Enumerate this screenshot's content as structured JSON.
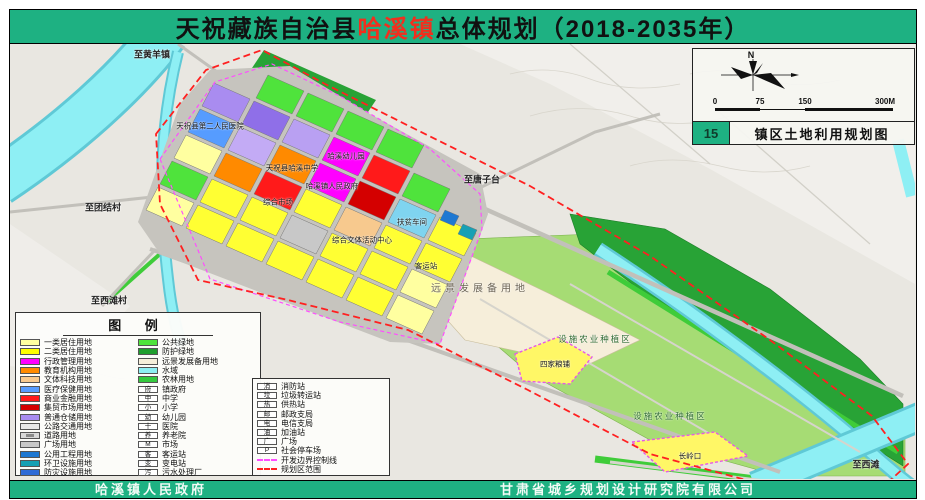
{
  "title": {
    "prefix": "天祝藏族自治县",
    "highlight": "哈溪镇",
    "suffix": "总体规划（2018-2035年）"
  },
  "map_index": {
    "number": "15",
    "name": "镇区土地利用规划图"
  },
  "compass": {
    "north_label": "N"
  },
  "scale_bar": {
    "ticks": [
      "0",
      "75",
      "150",
      "300M"
    ]
  },
  "legend": {
    "title": "图  例",
    "col1": [
      {
        "label": "一类居住用地",
        "c": "#ffffa0"
      },
      {
        "label": "二类居住用地",
        "c": "#ffff00"
      },
      {
        "label": "行政管理用地",
        "c": "#ff00ff"
      },
      {
        "label": "教育机构用地",
        "c": "#ff8a00"
      },
      {
        "label": "文体科技用地",
        "c": "#f7c98e"
      },
      {
        "label": "医疗保健用地",
        "c": "#569cff"
      },
      {
        "label": "商业金融用地",
        "c": "#ff1a1a"
      },
      {
        "label": "集贸市场用地",
        "c": "#d40000"
      },
      {
        "label": "普通仓储用地",
        "c": "#a98cf0"
      },
      {
        "label": "公路交通用地",
        "c": "#e8e8e8"
      },
      {
        "label": "道路用地",
        "road": true
      },
      {
        "label": "广场用地",
        "c": "#c8c8c8"
      },
      {
        "label": "公用工程用地",
        "c": "#1e78d2"
      },
      {
        "label": "环卫设施用地",
        "c": "#17a0b4"
      },
      {
        "label": "防灾设施用地",
        "c": "#2e6bd6"
      }
    ],
    "col2": [
      {
        "label": "公共绿地",
        "c": "#4fe33c"
      },
      {
        "label": "防护绿地",
        "c": "#1f9e2e"
      },
      {
        "label": "远景发展备用地",
        "c": "#f6eeda"
      },
      {
        "label": "水域",
        "c": "#8eeff4"
      },
      {
        "label": "农林用地",
        "c": "#35c93f"
      },
      {
        "label": "镇政府",
        "icon": "府"
      },
      {
        "label": "中学",
        "icon": "中"
      },
      {
        "label": "小学",
        "icon": "小"
      },
      {
        "label": "幼儿园",
        "icon": "幼"
      },
      {
        "label": "医院",
        "icon": "十"
      },
      {
        "label": "养老院",
        "icon": "养"
      },
      {
        "label": "市场",
        "icon": "M"
      },
      {
        "label": "客运站",
        "icon": "客"
      },
      {
        "label": "变电站",
        "icon": "变"
      },
      {
        "label": "污水处理厂",
        "icon": "污"
      }
    ],
    "col3": [
      {
        "label": "消防站",
        "icon": "消"
      },
      {
        "label": "垃圾转运站",
        "icon": "垃"
      },
      {
        "label": "供热站",
        "icon": "热"
      },
      {
        "label": "邮政支局",
        "icon": "邮"
      },
      {
        "label": "电信支局",
        "icon": "电"
      },
      {
        "label": "加油站",
        "icon": "油"
      },
      {
        "label": "广场",
        "icon": "广"
      },
      {
        "label": "社会停车场",
        "icon": "P"
      },
      {
        "label": "开发边界控制线",
        "line": "#ff4dff"
      },
      {
        "label": "规划区范围",
        "line": "#ff2020"
      }
    ]
  },
  "map": {
    "labels": [
      {
        "t": "至黄羊镇",
        "x": 142,
        "y": 10,
        "cls": "edge"
      },
      {
        "t": "至团结村",
        "x": 93,
        "y": 163,
        "cls": "edge"
      },
      {
        "t": "至西滩村",
        "x": 99,
        "y": 256,
        "cls": "edge"
      },
      {
        "t": "至唐子台",
        "x": 472,
        "y": 135,
        "cls": "edge"
      },
      {
        "t": "至西滩",
        "x": 856,
        "y": 420,
        "cls": "edge"
      },
      {
        "t": "远景发展备用地",
        "x": 470,
        "y": 243,
        "cls": "zone"
      },
      {
        "t": "设施农业种植区",
        "x": 585,
        "y": 295,
        "cls": "agri"
      },
      {
        "t": "设施农业种植区",
        "x": 660,
        "y": 372,
        "cls": "agri"
      },
      {
        "t": "天祝县第二人民医院",
        "x": 200,
        "y": 82,
        "cls": "parcel"
      },
      {
        "t": "天祝县哈溪中学",
        "x": 282,
        "y": 124,
        "cls": "parcel"
      },
      {
        "t": "哈溪幼儿园",
        "x": 336,
        "y": 112,
        "cls": "parcel"
      },
      {
        "t": "哈溪镇人民政府",
        "x": 322,
        "y": 142,
        "cls": "parcel"
      },
      {
        "t": "综合市场",
        "x": 268,
        "y": 158,
        "cls": "parcel"
      },
      {
        "t": "扶贫车间",
        "x": 402,
        "y": 178,
        "cls": "parcel"
      },
      {
        "t": "综合文体活动中心",
        "x": 352,
        "y": 196,
        "cls": "parcel"
      },
      {
        "t": "客运站",
        "x": 416,
        "y": 222,
        "cls": "parcel"
      },
      {
        "t": "四家粮铺",
        "x": 545,
        "y": 320,
        "cls": "parcel"
      },
      {
        "t": "长岭口",
        "x": 680,
        "y": 412,
        "cls": "parcel"
      }
    ]
  },
  "footer": {
    "left": "哈溪镇人民政府",
    "right": "甘肃省城乡规划设计研究院有限公司"
  },
  "colors": {
    "banner_green": "#1eb182",
    "title_red": "#f12f1e",
    "boundary_red": "#ff2020",
    "control_line_magenta": "#ff4dff",
    "water_cyan": "#8eeff4"
  }
}
